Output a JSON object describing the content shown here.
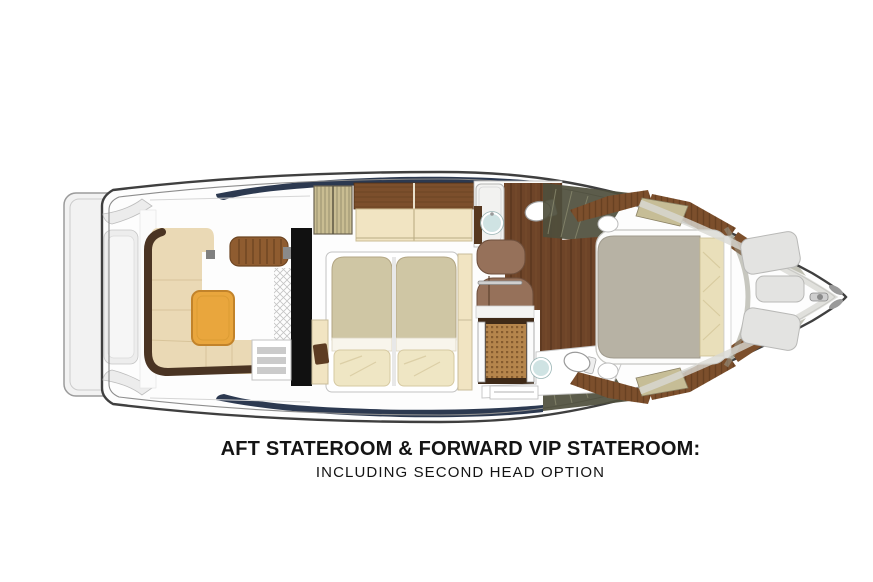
{
  "caption": {
    "title": "AFT STATEROOM & FORWARD VIP STATEROOM:",
    "subtitle": "INCLUDING SECOND HEAD OPTION"
  },
  "diagram": {
    "type": "yacht-overhead-floorplan",
    "features": [
      "swim-platform",
      "transom",
      "cockpit-c-settee",
      "cockpit-table",
      "cockpit-ribbed-bench",
      "cockpit-steps",
      "aft-stateroom-twin-beds",
      "louvered-locker",
      "wood-cabinet",
      "cream-settee",
      "nightstands",
      "forward-head-shower",
      "forward-head-sink",
      "forward-head-toilet",
      "windshield-glazing",
      "companionway-stairs",
      "teak-passage-floor",
      "second-head-shower-grate",
      "second-head-sink",
      "second-head-toilet",
      "vip-stateroom-bed",
      "vip-side-tables",
      "wood-slat-trim",
      "bow-sunpads",
      "anchor-fitting"
    ]
  },
  "colors": {
    "hull-outline": "#3f3f3f",
    "navy-trim": "#2c3950",
    "settee-beige": "#ead9b5",
    "settee-band": "#4a3423",
    "table-orange": "#e9a63d",
    "bench-brown": "#8f5c30",
    "cabinet-wood": "#7c4f2c",
    "cabinet-cream": "#f1e4c2",
    "duvet-khaki": "#cfc6a4",
    "pillow-cream": "#efe6c4",
    "wood-floor": "#6e4428",
    "step-brown": "#96715a",
    "grate-teak": "#b5854c",
    "sink-blue": "#cfe3e3",
    "vip-duvet-gray": "#b7b2a4",
    "vip-pillow": "#e9dfba",
    "khaki-panel": "#c6bd96",
    "glazing-olive": "#4e4e3c",
    "louver-khaki": "#c9bd92",
    "sunpad-gray": "#e3e3e1"
  }
}
